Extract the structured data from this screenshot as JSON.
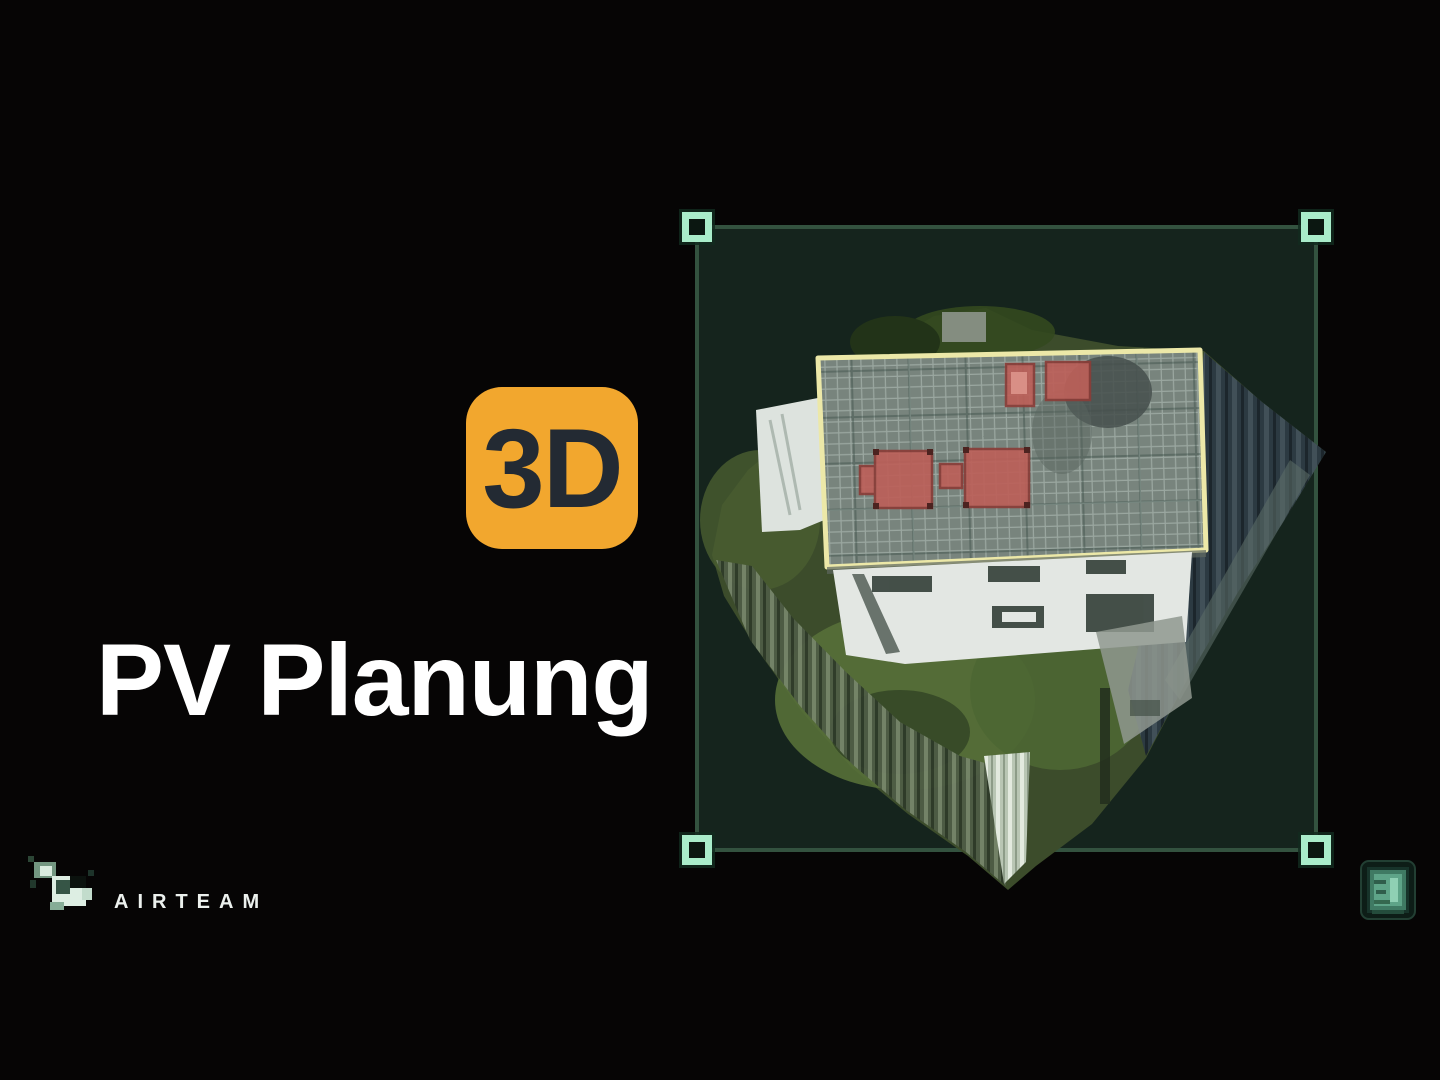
{
  "badge": {
    "label": "3D"
  },
  "heading": {
    "text": "PV Planung"
  },
  "branding": {
    "name": "AIRTEAM"
  },
  "colors": {
    "background": "#060505",
    "badge_bg": "#F2A72E",
    "badge_text": "#232A33",
    "heading_text": "#FFFFFF",
    "logo_text": "#ECF1EE",
    "selection_fill": "#15241D",
    "selection_border": "#33523F",
    "handle": "#A9ECCA",
    "roof_outline": "#ECE8A8",
    "roof_fill": "#78847D",
    "obstacle_red": "#BC6059",
    "grass_green": "#46582E"
  }
}
